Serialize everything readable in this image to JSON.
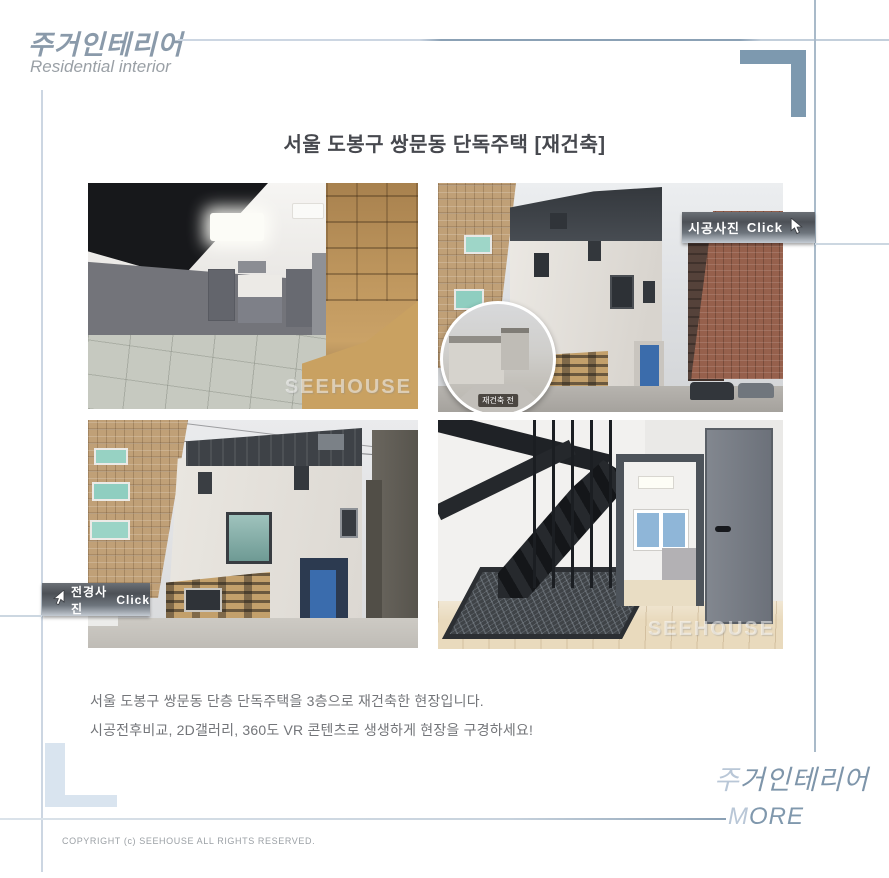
{
  "page": {
    "background": "#ffffff"
  },
  "colors": {
    "bracket_accent": "#7d99af",
    "bracket_light": "#d9e4ef",
    "line_light": "#ccd6e2",
    "line_dark": "#8ba1b5",
    "door_blue": "#3b6cab",
    "button_text": "#ffffff"
  },
  "header": {
    "logo_ko": "주거인테리어",
    "logo_en": "Residential interior"
  },
  "title": "서울 도봉구 쌍문동 단독주택 [재건축]",
  "gallery": {
    "construction_button": {
      "label": "시공사진",
      "click": "Click"
    },
    "panorama_button": {
      "label": "전경사진",
      "click": "Click"
    },
    "watermark": "SEEHOUSE",
    "inset_label": "재건축 전"
  },
  "description": {
    "line1": "서울 도봉구 쌍문동 단층 단독주택을 3층으로 재건축한 현장입니다.",
    "line2": "시공전후비교, 2D갤러리, 360도 VR 콘텐츠로  생생하게 현장을 구경하세요!"
  },
  "footer": {
    "brand_first": "주",
    "brand_rest": "거인테리어",
    "more_first": "M",
    "more_rest": "ORE",
    "copyright": "COPYRIGHT (c) SEEHOUSE ALL RIGHTS RESERVED."
  }
}
